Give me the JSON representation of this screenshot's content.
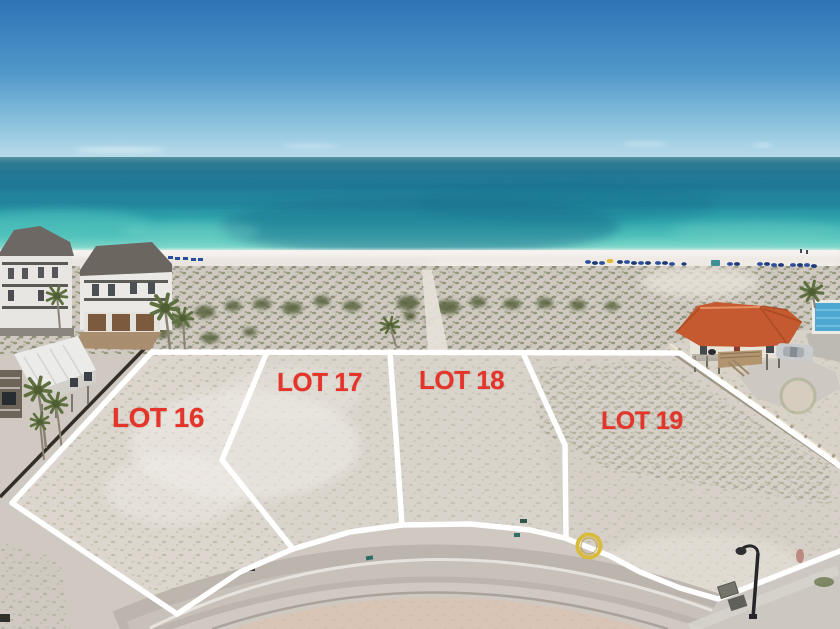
{
  "photo": {
    "description": "aerial beachfront view of four vacant sand lots outlined in white beside the gulf",
    "lots": [
      {
        "id": "lot-16",
        "label": "LOT 16"
      },
      {
        "id": "lot-17",
        "label": "LOT 17"
      },
      {
        "id": "lot-18",
        "label": "LOT 18"
      },
      {
        "id": "lot-19",
        "label": "LOT 19"
      }
    ],
    "colors": {
      "label_red": "#e5342a",
      "boundary_white": "#ffffff",
      "sky_top": "#2c74b5",
      "sky_horizon": "#b9dcea",
      "ocean_deep": "#1f7897",
      "ocean_turquoise": "#2ea3ab",
      "ocean_shallow": "#83d8cb",
      "beach_sand": "#ece6e1",
      "dune_sand": "#cfc9c1",
      "vegetation_olive": "#6e7a4e",
      "lot_sand": "#dbd5cd",
      "road_concrete": "#c9c4bd",
      "culdesac_sand": "#d9c5b5",
      "left_house_roof": "#6d6863",
      "right_house_roof": "#c5592f",
      "pool_blue": "#4fa8d2",
      "umbrella_blue": "#2b4f9e",
      "ring_yellow": "#d9bb3c"
    }
  }
}
